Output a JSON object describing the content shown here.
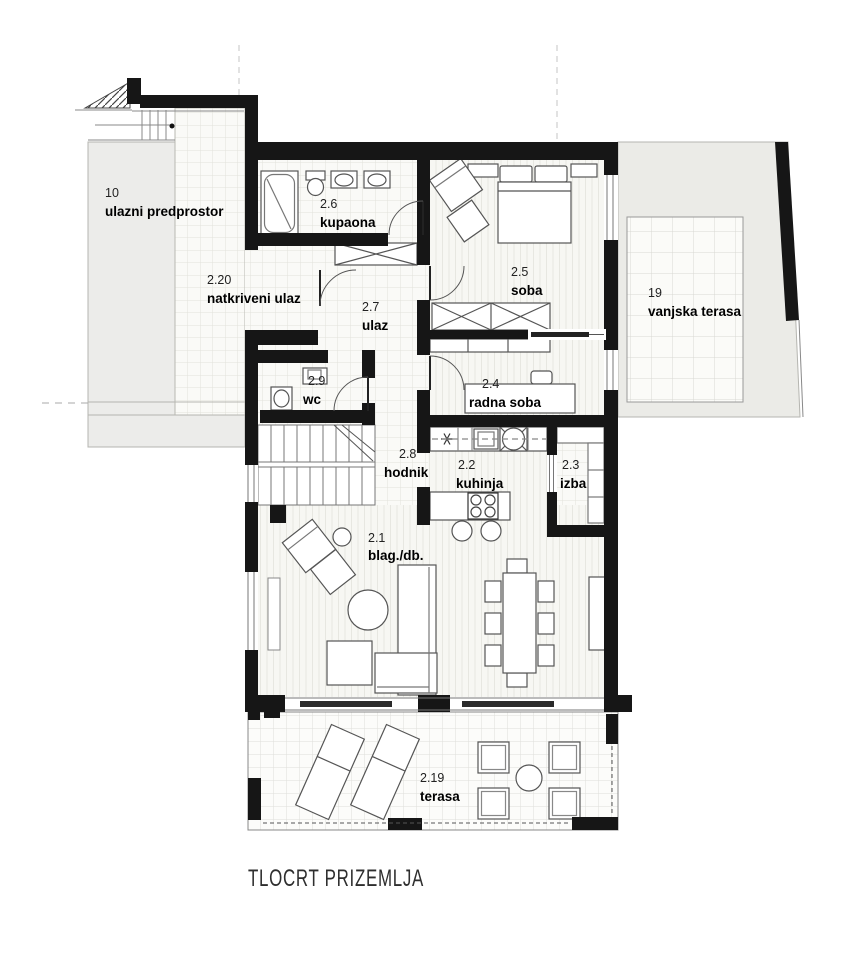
{
  "title": "TLOCRT PRIZEMLJA",
  "rooms": [
    {
      "id": "10",
      "name": "ulazni predprostor"
    },
    {
      "id": "2.20",
      "name": "natkriveni ulaz"
    },
    {
      "id": "2.6",
      "name": "kupaona"
    },
    {
      "id": "2.7",
      "name": "ulaz"
    },
    {
      "id": "2.5",
      "name": "soba"
    },
    {
      "id": "19",
      "name": "vanjska terasa"
    },
    {
      "id": "2.9",
      "name": "wc"
    },
    {
      "id": "2.4",
      "name": "radna soba"
    },
    {
      "id": "2.8",
      "name": "hodnik"
    },
    {
      "id": "2.2",
      "name": "kuhinja"
    },
    {
      "id": "2.3",
      "name": "izba"
    },
    {
      "id": "2.1",
      "name": "blag./db."
    },
    {
      "id": "2.19",
      "name": "terasa"
    }
  ],
  "fixtures": [
    "bathtub",
    "toilet",
    "sink",
    "wardrobe",
    "bed",
    "armchair",
    "desk",
    "kitchen-counter",
    "cooktop-island",
    "stairs",
    "sofa",
    "dining-table",
    "coffee-table",
    "sun-lounger",
    "terrace-table",
    "terrace-chair"
  ],
  "colors": {
    "wall": "#161616",
    "exterior_fill": "#ebebe7",
    "tile_line": "#e2e2db",
    "stripe_line": "#e7e7e1",
    "thin_line": "#555555"
  }
}
